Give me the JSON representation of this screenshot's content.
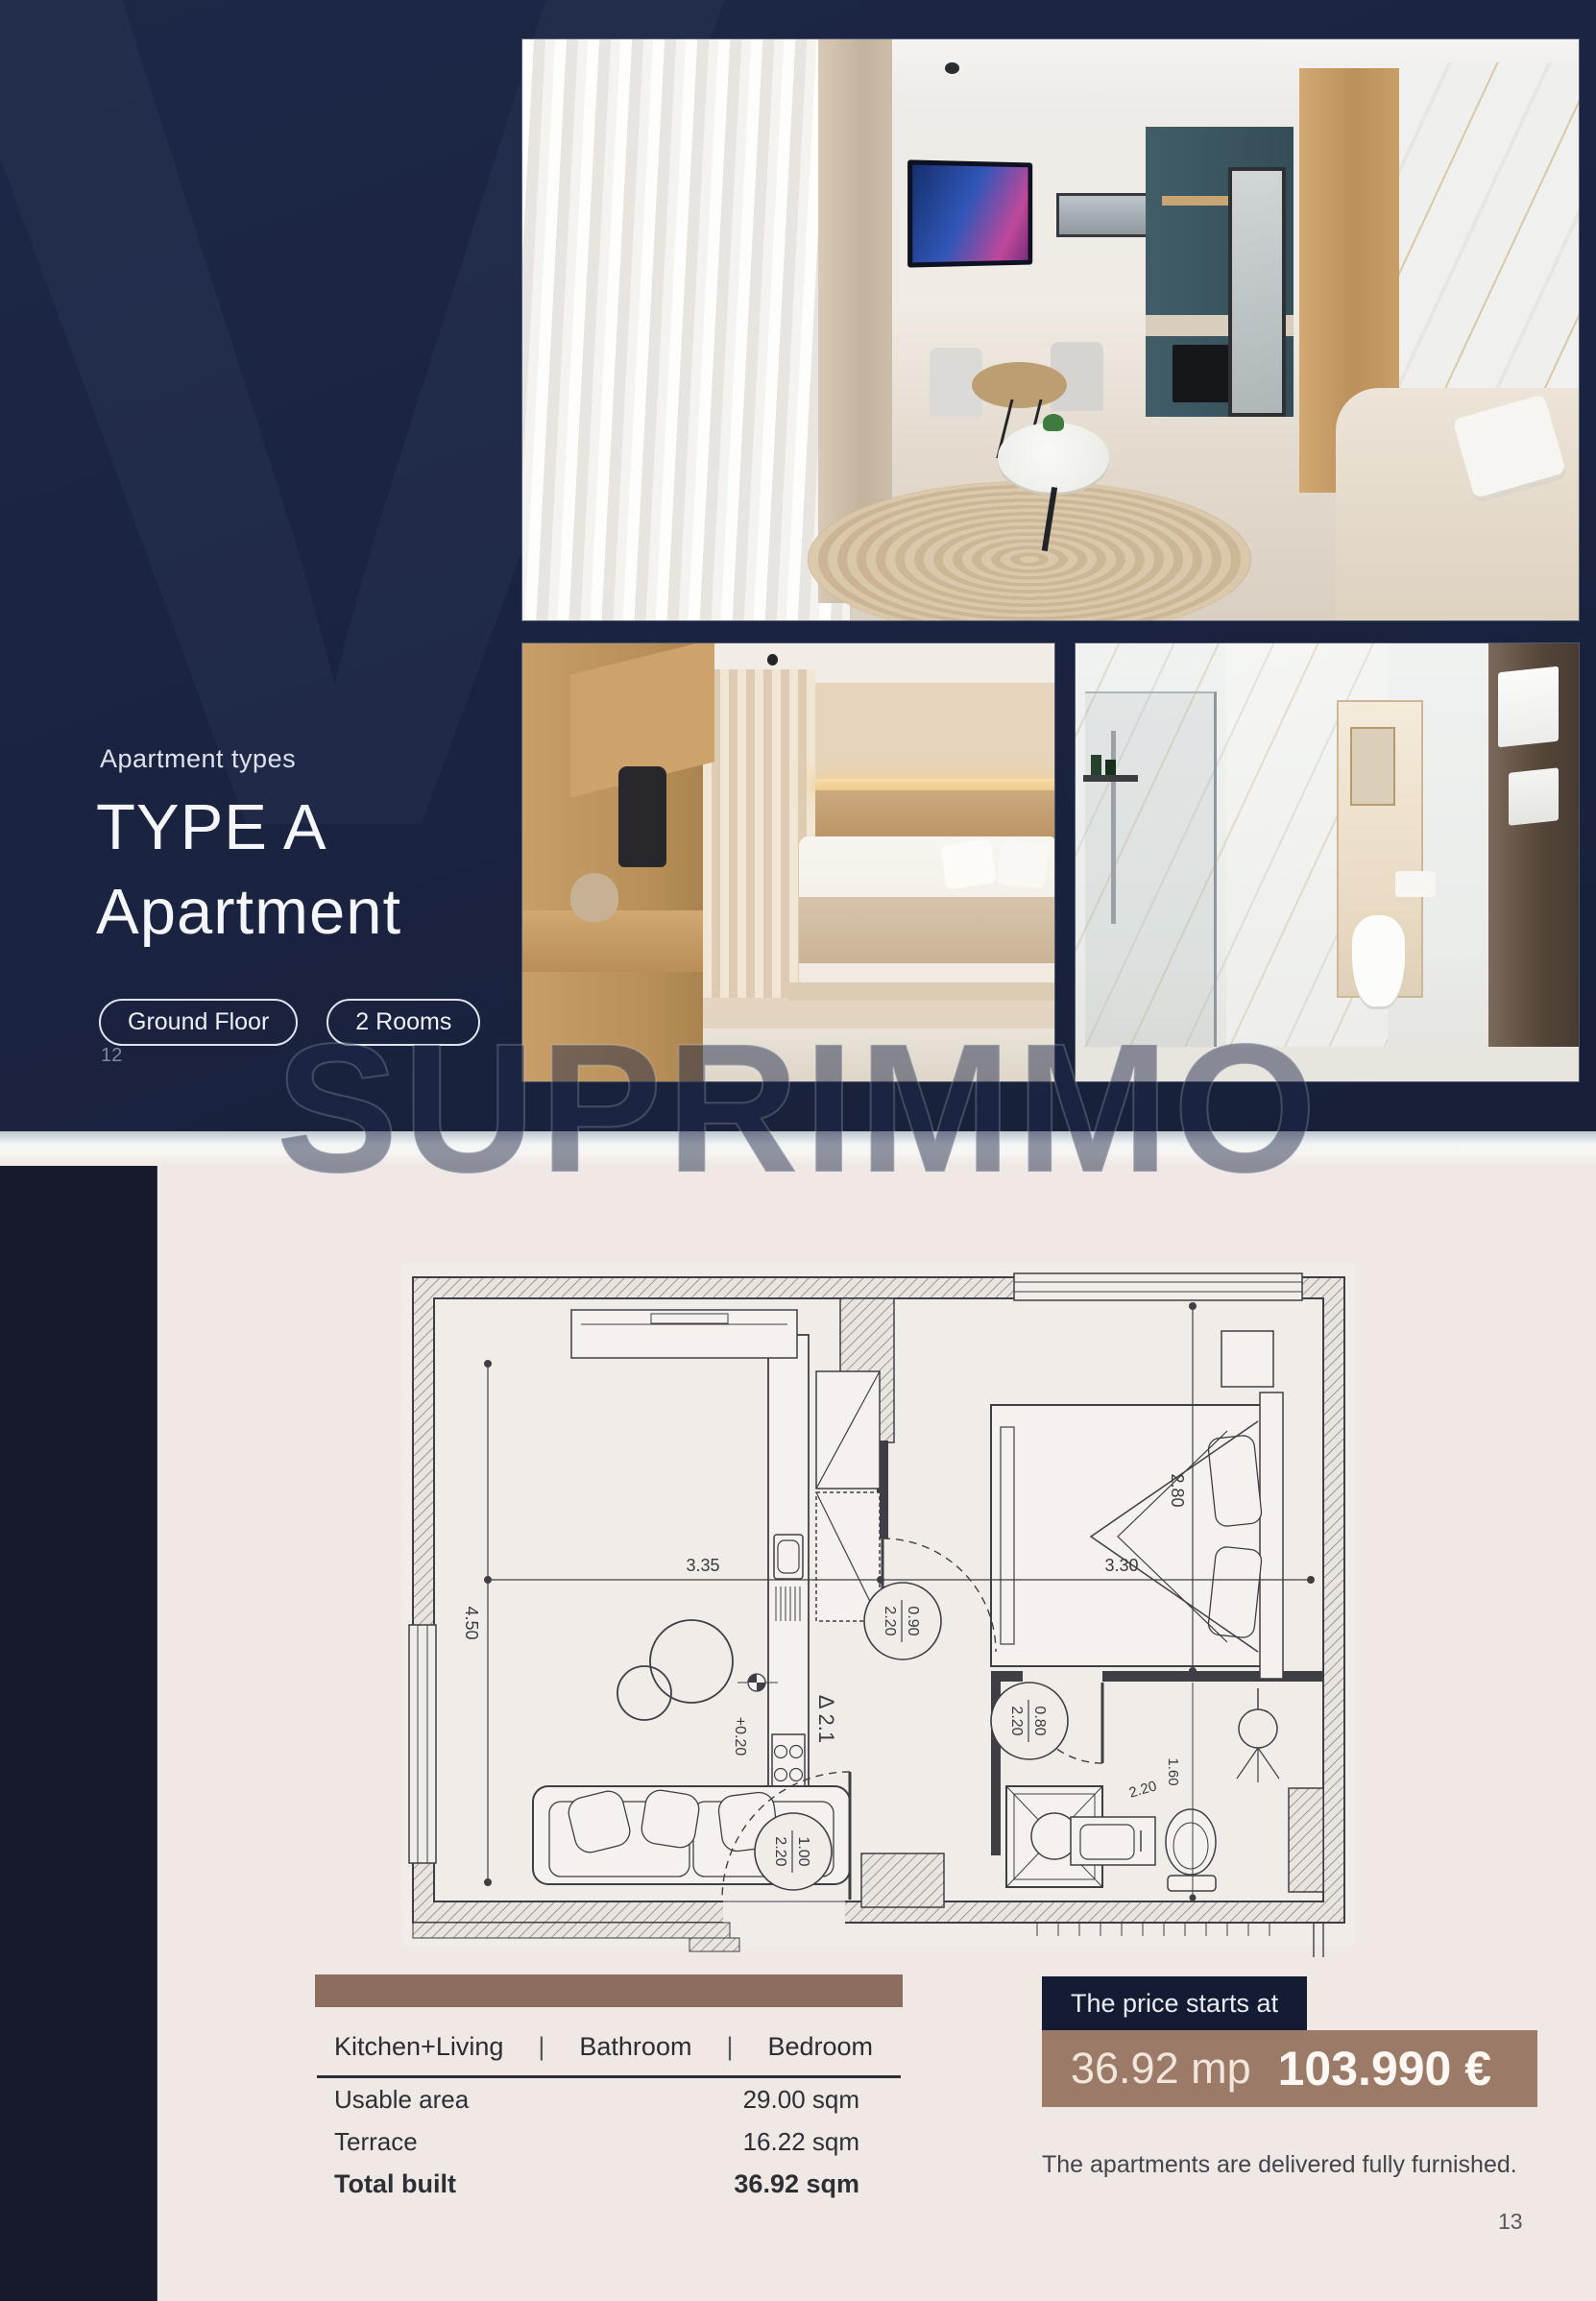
{
  "colors": {
    "hero_navy": "#1A2340",
    "sidebar_navy": "#171A2B",
    "price_tag_navy": "#141C33",
    "beige_background": "#EFE8E5",
    "table_bar_brown": "#8B6E5E",
    "price_bar_brown": "#9B7A68"
  },
  "watermark": {
    "brand": "SUPRIMMO",
    "letter": "V"
  },
  "hero": {
    "eyebrow": "Apartment types",
    "title_line1": "TYPE A",
    "title_line2": "Apartment",
    "badges": [
      {
        "label": "Ground Floor"
      },
      {
        "label": "2 Rooms"
      }
    ],
    "page_number": "12"
  },
  "plan": {
    "dim_living_width": "3.35",
    "dim_living_height": "4.50",
    "dim_bedroom_width": "3.30",
    "dim_bedroom_height": "2.80",
    "dim_bath_width": "1.60",
    "dim_bath_height": "2.20",
    "door_living_bedroom": {
      "width": "0.90",
      "height": "2.20"
    },
    "door_bathroom": {
      "width": "0.80",
      "height": "2.20"
    },
    "door_entrance": {
      "width": "1.00",
      "height": "2.20"
    },
    "unit_label": "Δ 2.1",
    "level_label": "+0.20"
  },
  "details": {
    "rooms": [
      "Kitchen+Living",
      "Bathroom",
      "Bedroom"
    ],
    "separator": "|",
    "rows": [
      {
        "label": "Usable area",
        "value": "29.00 sqm"
      },
      {
        "label": "Terrace",
        "value": "16.22 sqm"
      },
      {
        "label": "Total built",
        "value": "36.92 sqm"
      }
    ]
  },
  "price": {
    "tag": "The price starts at",
    "area": "36.92 mp",
    "amount": "103.990 €",
    "note": "The apartments are delivered fully furnished.",
    "page_number": "13"
  }
}
